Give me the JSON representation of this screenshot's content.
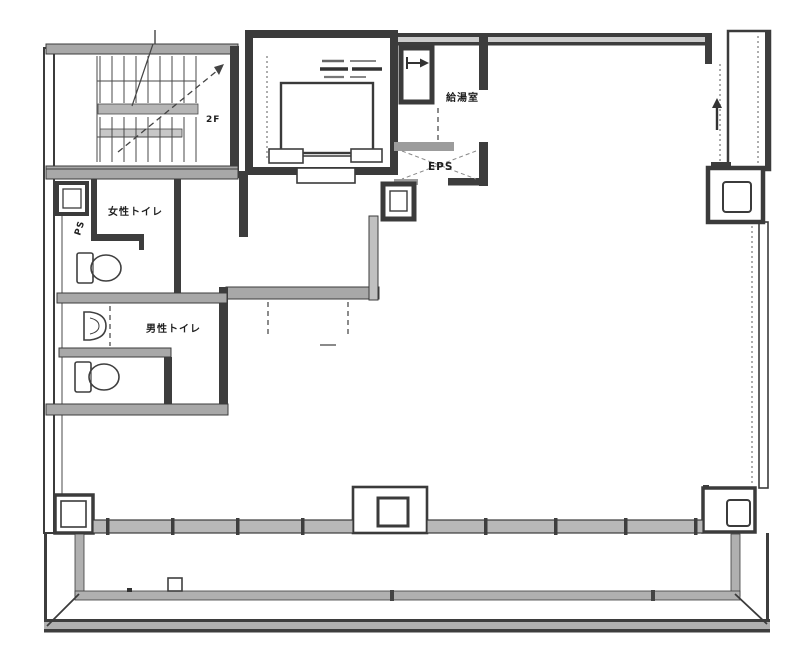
{
  "drawing": {
    "kind": "floor-plan",
    "labels": {
      "stair_level": "2F",
      "kitchenette": "給湯室",
      "eps": "EPS",
      "pipe_space": "PS",
      "womens_toilet": "女性トイレ",
      "mens_toilet": "男性トイレ"
    },
    "colors": {
      "line": "#3b3b3b",
      "wall_gray": "#a8a8a8",
      "background": "#ffffff"
    }
  }
}
